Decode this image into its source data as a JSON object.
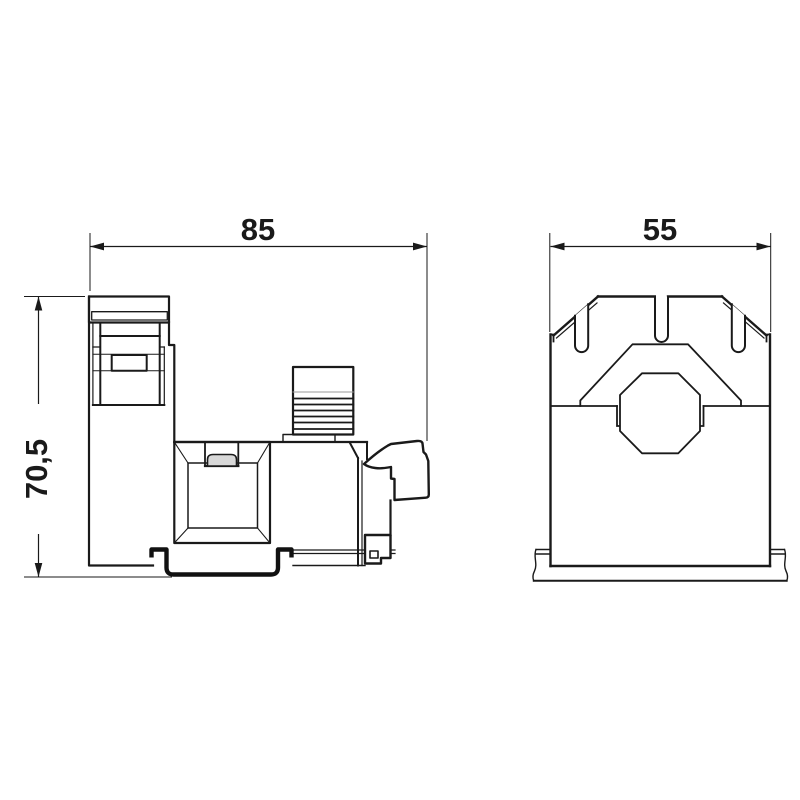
{
  "drawing": {
    "type": "technical-dimension-drawing",
    "views": {
      "side": {
        "name": "side view"
      },
      "front": {
        "name": "front view"
      }
    }
  },
  "dimensions": {
    "side_width": "85",
    "side_height": "70,5",
    "front_width": "55"
  },
  "colors": {
    "line": "#1a1a1a",
    "thin_line": "#444444",
    "tab_fill": "#d8d8d8",
    "background": "#ffffff"
  }
}
